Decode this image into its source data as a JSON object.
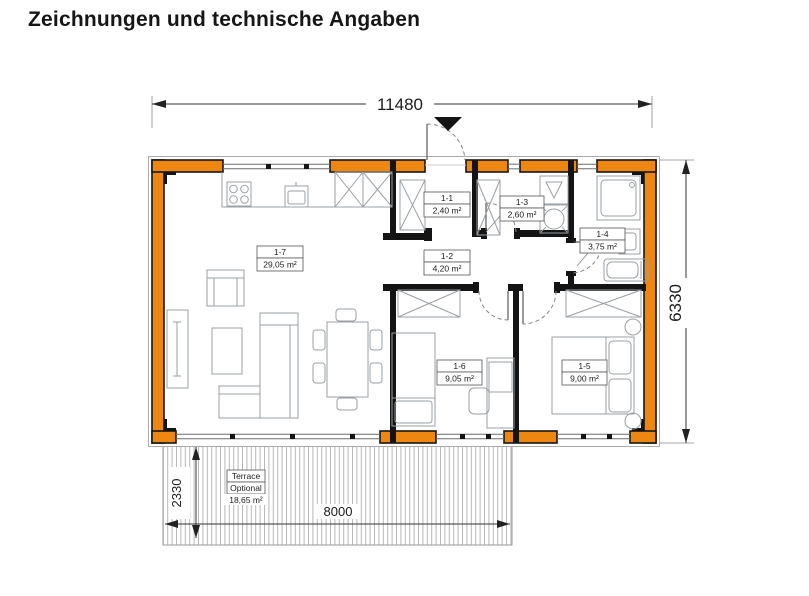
{
  "page": {
    "title": "Zeichnungen und technische Angaben"
  },
  "plan": {
    "dimensions": {
      "overall_width_mm": "11480",
      "overall_depth_mm": "6330",
      "terrace_width_mm": "8000",
      "terrace_depth_mm": "2330"
    },
    "rooms": [
      {
        "id": "1-1",
        "area": "2,40 m²"
      },
      {
        "id": "1-2",
        "area": "4,20 m²"
      },
      {
        "id": "1-3",
        "area": "2,60 m²"
      },
      {
        "id": "1-4",
        "area": "3,75 m²"
      },
      {
        "id": "1-5",
        "area": "9,00 m²"
      },
      {
        "id": "1-6",
        "area": "9,05 m²"
      },
      {
        "id": "1-7",
        "area": "29,05 m²"
      }
    ],
    "terrace": {
      "label": "Terrace",
      "status": "Optional",
      "area": "18,65 m²"
    },
    "colors": {
      "wall_fill": "#EE8712",
      "wall_outline": "#161616",
      "furniture_line": "#9aa0a5",
      "dimension_line": "#333333"
    }
  }
}
